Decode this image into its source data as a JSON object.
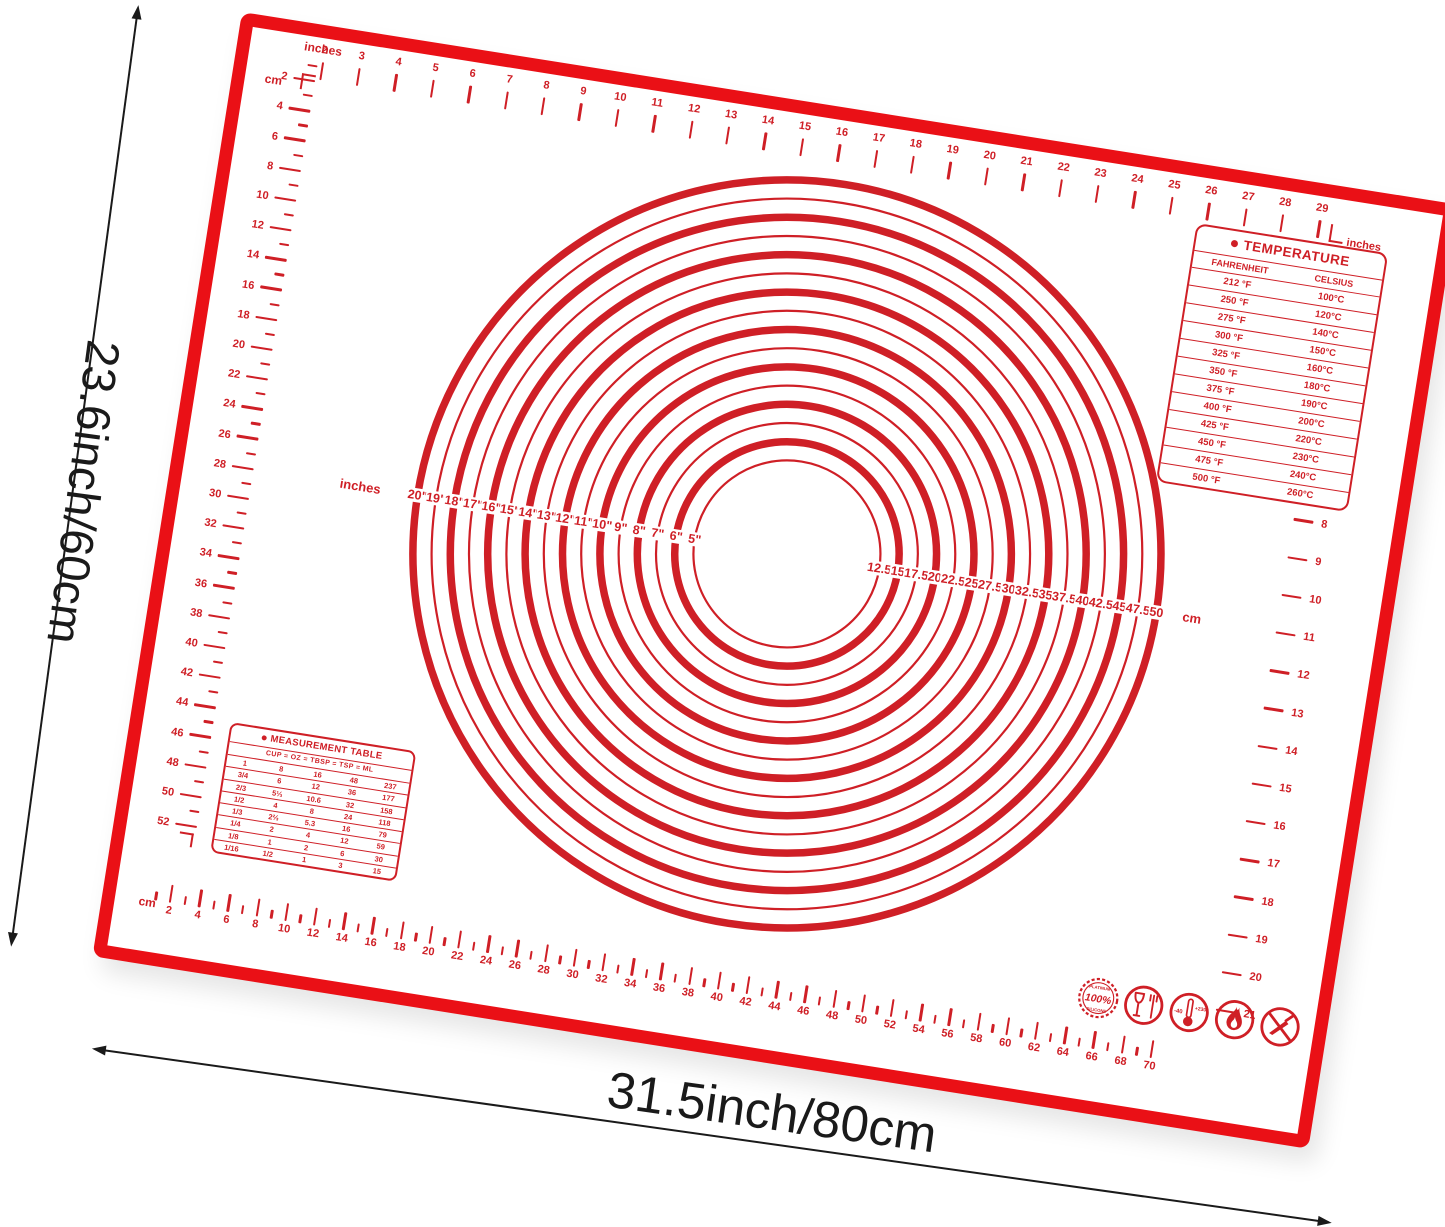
{
  "colors": {
    "mat_red": "#ea1016",
    "print_red": "#cf1f26",
    "dimension_black": "#1a1a1a"
  },
  "dimensions": {
    "height_label": "23.6inch/60cm",
    "width_label": "31.5inch/80cm"
  },
  "rulers": {
    "top": {
      "unit_label": "inches",
      "start": 2,
      "end": 29
    },
    "left": {
      "unit_label": "cm",
      "start": 1,
      "end": 52,
      "numbered_step": 2
    },
    "right": {
      "unit_label": "inches",
      "start": 2,
      "end": 21
    },
    "bottom": {
      "unit_label": "cm",
      "start": 1,
      "end": 70,
      "numbered_step": 2
    }
  },
  "circles": {
    "unit_left_label": "inches",
    "unit_right_label": "cm",
    "diameters_inch": [
      20,
      19,
      18,
      17,
      16,
      15,
      14,
      13,
      12,
      11,
      10,
      9,
      8,
      7,
      6,
      5
    ],
    "diameters_cm": [
      12.5,
      15,
      17.5,
      20,
      22.5,
      25,
      27.5,
      30,
      32.5,
      35,
      37.5,
      40,
      42.5,
      45,
      47.5,
      50
    ]
  },
  "temperature_table": {
    "title": "TEMPERATURE",
    "columns": [
      "FAHRENHEIT",
      "CELSIUS"
    ],
    "rows": [
      [
        "212 °F",
        "100°C"
      ],
      [
        "250 °F",
        "120°C"
      ],
      [
        "275 °F",
        "140°C"
      ],
      [
        "300 °F",
        "150°C"
      ],
      [
        "325 °F",
        "160°C"
      ],
      [
        "350 °F",
        "180°C"
      ],
      [
        "375 °F",
        "190°C"
      ],
      [
        "400 °F",
        "200°C"
      ],
      [
        "425 °F",
        "220°C"
      ],
      [
        "450 °F",
        "230°C"
      ],
      [
        "475 °F",
        "240°C"
      ],
      [
        "500 °F",
        "260°C"
      ]
    ]
  },
  "measurement_table": {
    "title": "MEASUREMENT TABLE",
    "columns": [
      "CUP",
      "OZ",
      "TBSP",
      "TSP",
      "ML"
    ],
    "column_separator": "=",
    "rows": [
      [
        "1",
        "8",
        "16",
        "48",
        "237"
      ],
      [
        "3/4",
        "6",
        "12",
        "36",
        "177"
      ],
      [
        "2/3",
        "5⅓",
        "10.6",
        "32",
        "158"
      ],
      [
        "1/2",
        "4",
        "8",
        "24",
        "118"
      ],
      [
        "1/3",
        "2⅔",
        "5.3",
        "16",
        "79"
      ],
      [
        "1/4",
        "2",
        "4",
        "12",
        "59"
      ],
      [
        "1/8",
        "1",
        "2",
        "6",
        "30"
      ],
      [
        "1/16",
        "1/2",
        "1",
        "3",
        "15"
      ]
    ]
  },
  "badges": {
    "stamp": {
      "top": "PLATINUM",
      "center": "100%",
      "bottom": "SILICONE"
    },
    "thermometer": {
      "min": "-40",
      "max": "+230"
    }
  }
}
